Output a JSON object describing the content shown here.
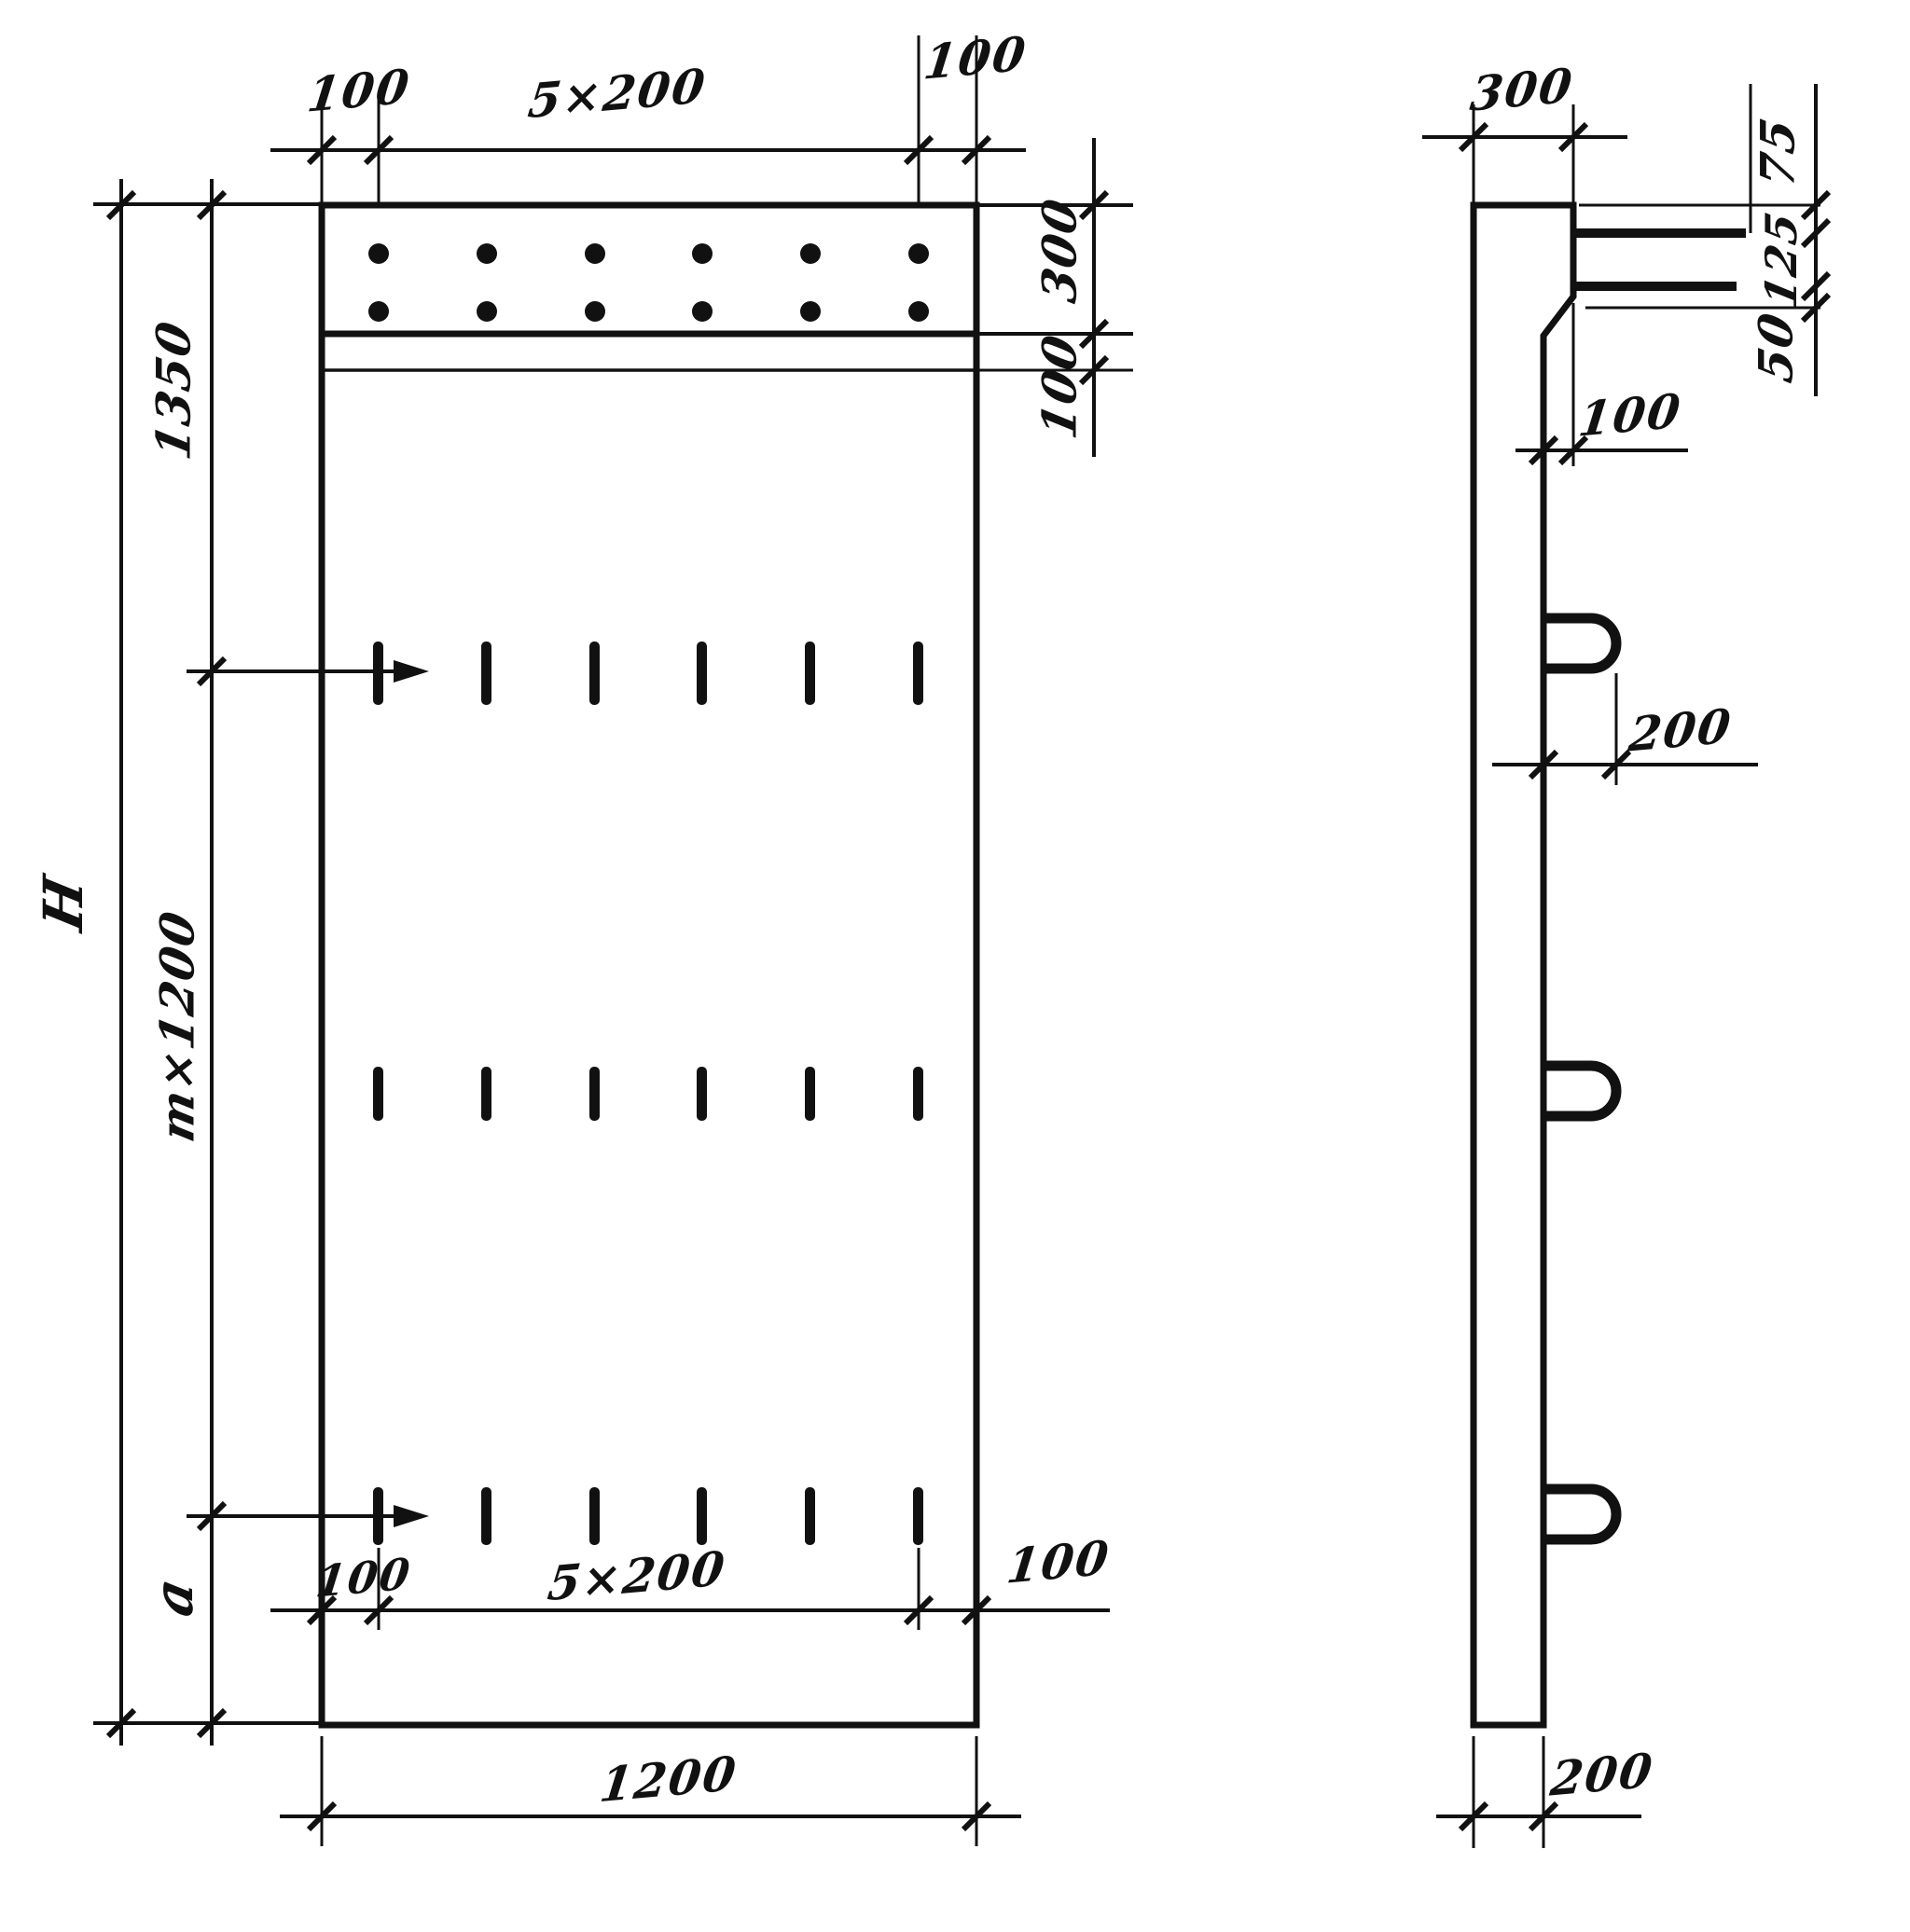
{
  "meta": {
    "drawing_type": "structural precast panel working drawing, front and side elevations",
    "ink_color": "#111111",
    "paper_color": "#ffffff"
  },
  "front_view": {
    "top_dims": {
      "left_margin": "100",
      "hole_spacing": "5×200",
      "right_margin": "100"
    },
    "right_dims": {
      "top_band_height": "300",
      "gap_below_band": "100"
    },
    "left_dims": {
      "overall_height": "H",
      "top_zone": "1350",
      "middle_zone": "m×1200",
      "bottom_zone": "a"
    },
    "bottom_dims": {
      "left_margin": "100",
      "slot_spacing": "5×200",
      "right_margin": "100",
      "overall_width": "1200"
    }
  },
  "side_view": {
    "top_dims": {
      "top_thickness": "300"
    },
    "right_dims": {
      "bar_top_offset": "75",
      "bar_spacing": "125",
      "bar_bottom_offset": "50"
    },
    "middle_dims": {
      "step_depth": "100",
      "loop_projection": "200"
    },
    "bottom_dims": {
      "bottom_thickness": "200"
    }
  }
}
